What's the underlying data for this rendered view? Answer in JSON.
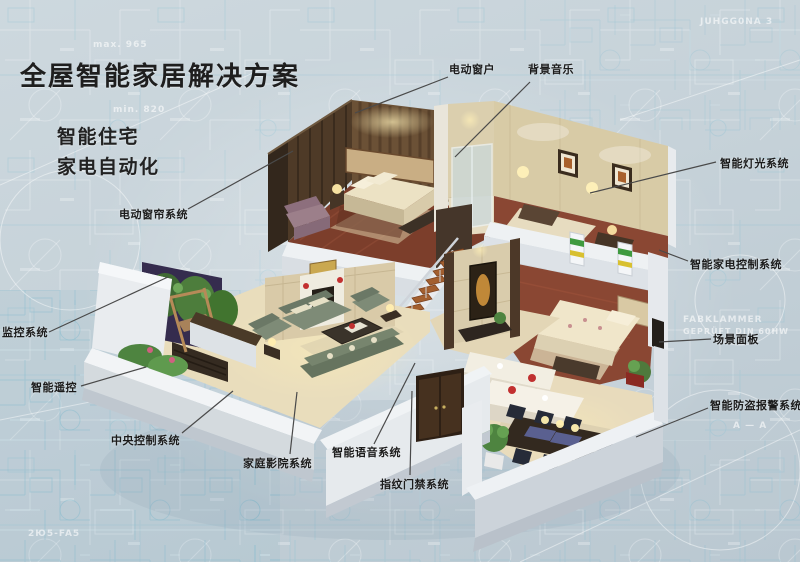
{
  "page": {
    "title": "全屋智能家居解决方案",
    "subtitles": [
      "智能住宅",
      "家电自动化"
    ]
  },
  "callouts": {
    "electric_window": "电动窗户",
    "background_music": "背景音乐",
    "smart_lighting": "智能灯光系统",
    "appliance_control": "智能家电控制系统",
    "scene_panel": "场景面板",
    "burglar_alarm": "智能防盗报警系统",
    "electric_curtain": "电动窗帘系统",
    "monitoring": "监控系统",
    "smart_remote": "智能遥控",
    "central_control": "中央控制系统",
    "home_theater": "家庭影院系统",
    "voice_system": "智能语音系统",
    "fingerprint_access": "指纹门禁系统"
  },
  "background_texts": {
    "t1": "max. 965",
    "t2": "min. 820",
    "t3": "A — A",
    "t4": "FABKLAMMER",
    "t5": "GEPRÜFT DIN 60HW",
    "t6": "JUHGG0NA 3",
    "t7": "2Ю5-FA5"
  },
  "colors": {
    "background": "#c7d3da",
    "label_text": "#1b1b1b",
    "leader_line": "#4a4a4a",
    "wall_light": "#e9ecef",
    "floor_wood": "#7c3e2b",
    "floor_tile": "#e8dcbc",
    "sofa_green": "#7d8a76",
    "plant_green": "#4e8440",
    "accent_red": "#c03030",
    "panel_green": "#3f9a3f",
    "panel_yellow": "#d8c030",
    "backdrop_purple": "#352c4e"
  }
}
